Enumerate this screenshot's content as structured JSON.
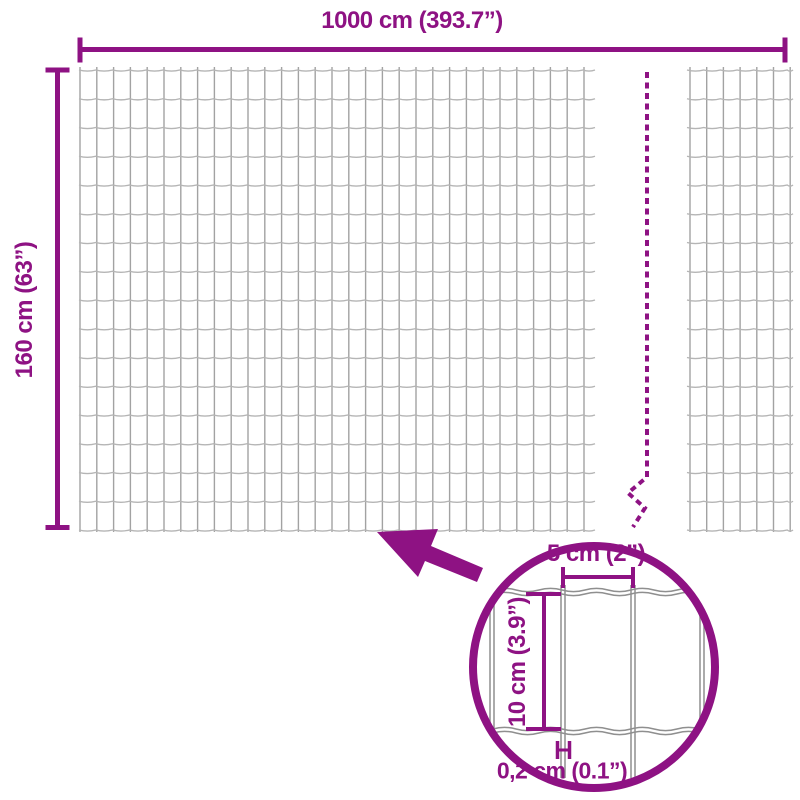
{
  "diagram": {
    "overall_width_label": "1000 cm (393.7”)",
    "overall_height_label": "160 cm (63”)",
    "detail": {
      "mesh_width_label": "5 cm (2”)",
      "mesh_height_label": "10 cm (3.9”)",
      "wire_thickness_label": "0,2 cm (0.1”)"
    },
    "colors": {
      "accent": "#8E1283",
      "mesh_vertical_wire": "#A2A2A2",
      "mesh_horizontal_wire": "#B5B5B5",
      "detail_wire": "#8F8F8F",
      "background": "#FFFFFF"
    },
    "icons": {
      "arrow": "detail-arrow-icon",
      "magnifier": "detail-circle"
    }
  }
}
